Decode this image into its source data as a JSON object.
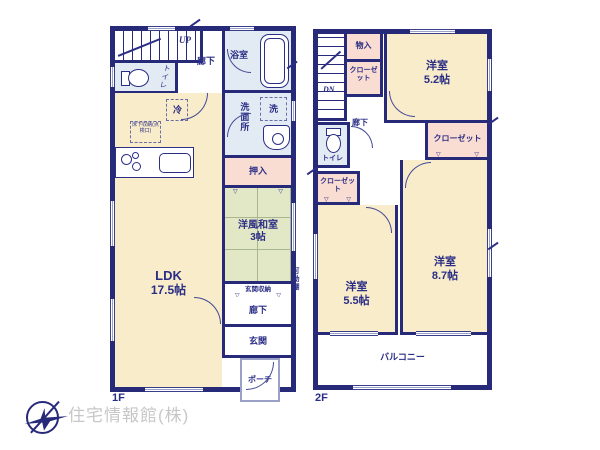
{
  "colors": {
    "wall": "#272a78",
    "text": "#2b2e85",
    "room_cream": "#f8ecca",
    "tatami_green": "#e2e7c6",
    "wet_blue": "#e2ebf4",
    "closet_pink": "#f9dcd2",
    "logo_text_gray": "#c7c7c7"
  },
  "f1": {
    "floor": "1F",
    "up": "UP",
    "hall_top": "廊下",
    "toilet": "トイレ",
    "bath": "浴室",
    "washer": "洗",
    "washroom": "洗面所",
    "fridge": "冷",
    "floor_storage": "床下収納(点検口)",
    "oshiire": "押入",
    "tatami_name": "洋風和室",
    "tatami_size": "3帖",
    "ldk_name": "LDK",
    "ldk_size": "17.5帖",
    "entrance_storage": "玄関収納",
    "movable_shelf": "可動棚",
    "hall_bottom": "廊下",
    "entrance": "玄関",
    "porch": "ポーチ"
  },
  "f2": {
    "floor": "2F",
    "dn": "DN",
    "storage": "物入",
    "closet_a": "クローゼット",
    "closet_b": "クローゼット",
    "closet_c": "クローゼット",
    "hall": "廊下",
    "toilet": "トイレ",
    "room_a_name": "洋室",
    "room_a_size": "5.2帖",
    "room_b_name": "洋室",
    "room_b_size": "5.5帖",
    "room_c_name": "洋室",
    "room_c_size": "8.7帖",
    "balcony": "バルコニー"
  },
  "footer": {
    "company": "住宅情報館(株)"
  }
}
